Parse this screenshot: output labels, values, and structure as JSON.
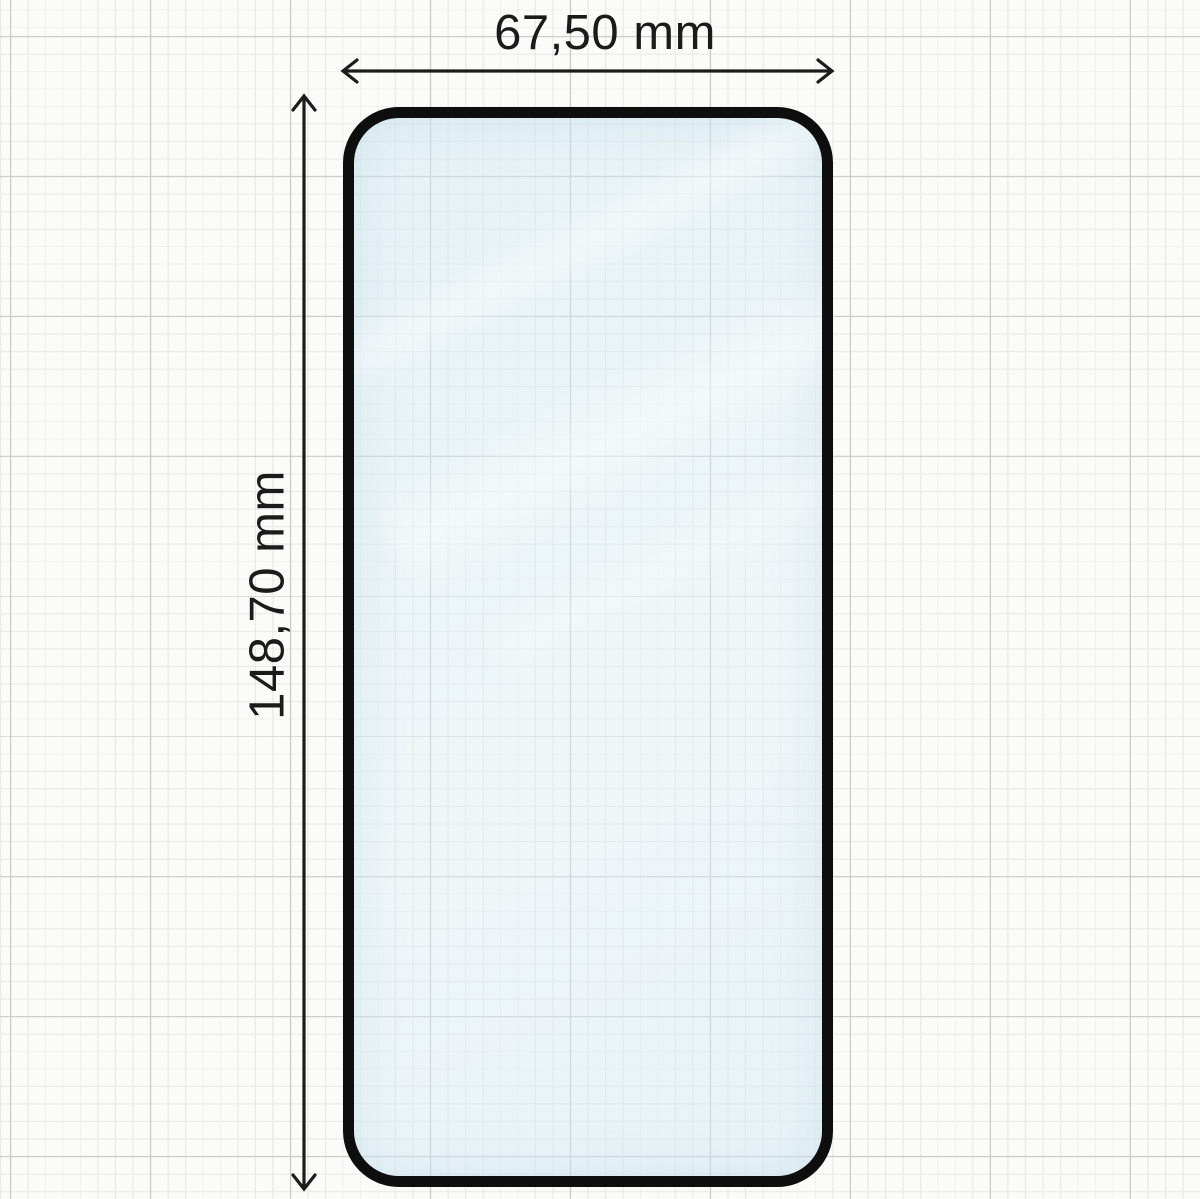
{
  "diagram": {
    "width_label": "67,50 mm",
    "height_label": "148,70 mm"
  },
  "colors": {
    "paper": "#fbfbfa",
    "grid_minor": "#e9e9e9",
    "grid_major": "#cacaca",
    "protector_border": "#0e0e0e",
    "glass_tint": "#deeef5",
    "glass_highlight": "#ffffff",
    "dimension_line": "#1c1c1c",
    "label_text": "#1b1b1b"
  }
}
